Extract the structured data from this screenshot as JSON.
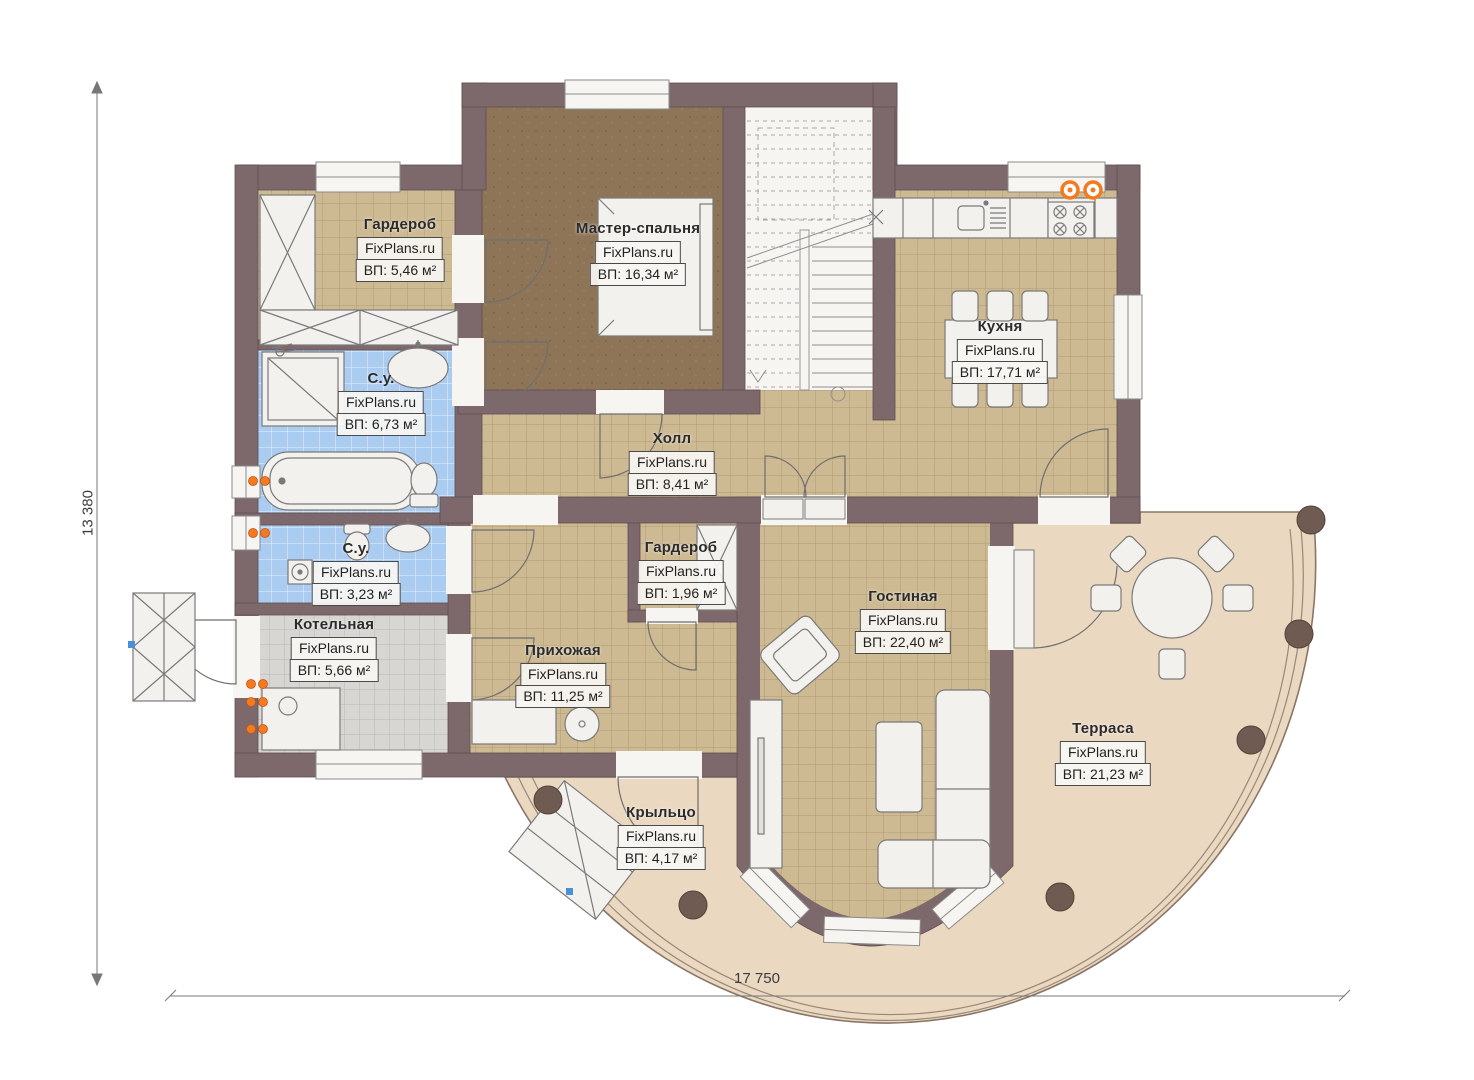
{
  "plan": {
    "rooms": [
      {
        "id": "wardrobe-1",
        "name": "Гардероб",
        "watermark": "FixPlans.ru",
        "area": "ВП: 5,46 м²"
      },
      {
        "id": "master-bedroom",
        "name": "Мастер-спальня",
        "watermark": "FixPlans.ru",
        "area": "ВП: 16,34 м²"
      },
      {
        "id": "kitchen",
        "name": "Кухня",
        "watermark": "FixPlans.ru",
        "area": "ВП: 17,71 м²"
      },
      {
        "id": "bathroom-1",
        "name": "С.у.",
        "watermark": "FixPlans.ru",
        "area": "ВП: 6,73 м²"
      },
      {
        "id": "hall",
        "name": "Холл",
        "watermark": "FixPlans.ru",
        "area": "ВП: 8,41 м²"
      },
      {
        "id": "bathroom-2",
        "name": "С.у.",
        "watermark": "FixPlans.ru",
        "area": "ВП: 3,23 м²"
      },
      {
        "id": "wardrobe-2",
        "name": "Гардероб",
        "watermark": "FixPlans.ru",
        "area": "ВП: 1,96 м²"
      },
      {
        "id": "boiler-room",
        "name": "Котельная",
        "watermark": "FixPlans.ru",
        "area": "ВП: 5,66 м²"
      },
      {
        "id": "entrance-hall",
        "name": "Прихожая",
        "watermark": "FixPlans.ru",
        "area": "ВП: 11,25 м²"
      },
      {
        "id": "living-room",
        "name": "Гостиная",
        "watermark": "FixPlans.ru",
        "area": "ВП: 22,40 м²"
      },
      {
        "id": "terrace",
        "name": "Терраса",
        "watermark": "FixPlans.ru",
        "area": "ВП: 21,23 м²"
      },
      {
        "id": "porch",
        "name": "Крыльцо",
        "watermark": "FixPlans.ru",
        "area": "ВП: 4,17 м²"
      }
    ],
    "dimensions": {
      "height": "13 380",
      "width": "17 750"
    },
    "colors": {
      "wall": "#7d696c",
      "tile_beige": "#cdb992",
      "floor_brown": "#8e7557",
      "tile_blue": "#abccf1",
      "tile_gray": "#d7d6d3",
      "outdoor": "#ead8c1",
      "fixture": "#f2f1ed",
      "radiator": "#f47a20",
      "column": "#6f5b51"
    }
  }
}
